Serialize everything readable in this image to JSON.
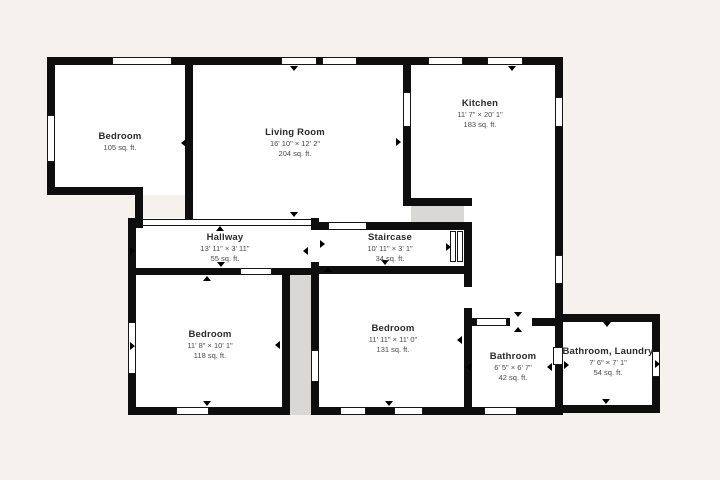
{
  "colors": {
    "background": "#f5f2ee",
    "wall": "#0e0e0e",
    "room_fill": "#ffffff",
    "void_fill": "#d9d8d5",
    "text_primary": "#2a2a2a",
    "text_secondary": "#4a4a4a"
  },
  "rooms": [
    {
      "name": "Bedroom",
      "area": "105 sq. ft."
    },
    {
      "name": "Living Room",
      "dims": "16' 10\" × 12' 2\"",
      "area": "204 sq. ft."
    },
    {
      "name": "Kitchen",
      "dims": "11' 7\" × 20' 1\"",
      "area": "183 sq. ft."
    },
    {
      "name": "Hallway",
      "dims": "13' 11\" × 3' 11\"",
      "area": "55 sq. ft."
    },
    {
      "name": "Staircase",
      "dims": "10' 11\" × 3' 1\"",
      "area": "34 sq. ft."
    },
    {
      "name": "Bedroom",
      "dims": "11' 8\" × 10' 1\"",
      "area": "118 sq. ft."
    },
    {
      "name": "Bedroom",
      "dims": "11' 11\" × 11' 0\"",
      "area": "131 sq. ft."
    },
    {
      "name": "Bathroom",
      "dims": "6' 5\" × 6' 7\"",
      "area": "42 sq. ft."
    },
    {
      "name": "Bathroom, Laundry",
      "dims": "7' 6\" × 7' 1\"",
      "area": "54 sq. ft."
    }
  ]
}
